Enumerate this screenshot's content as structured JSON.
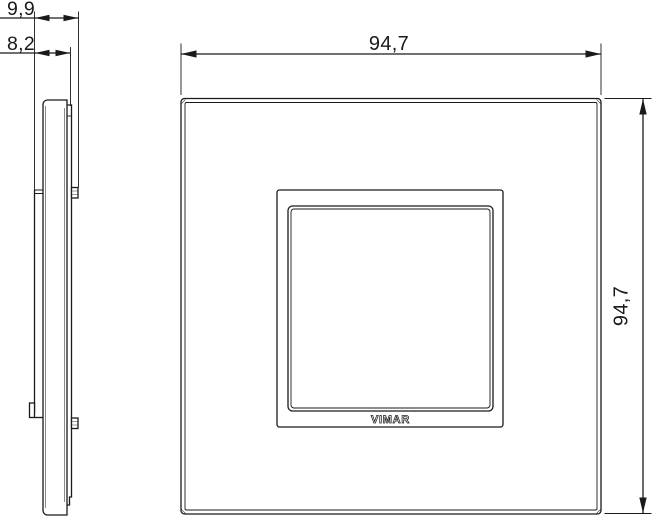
{
  "colors": {
    "background": "#ffffff",
    "line": "#1a1a1a"
  },
  "views": {
    "side": {
      "dims": {
        "depth_total": "9,9",
        "depth_plate": "8,2"
      }
    },
    "front": {
      "brand": "VIMAR",
      "dims": {
        "width": "94,7",
        "height": "94,7"
      }
    }
  }
}
